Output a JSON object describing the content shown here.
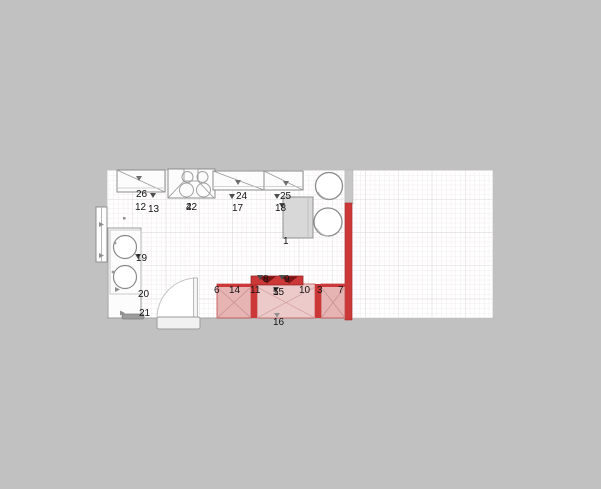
{
  "plan": {
    "type": "kitchen-floor-plan",
    "labels": {
      "n1": "1",
      "n3": "3",
      "n4": "4",
      "n5": "5",
      "n6": "6",
      "n7": "7",
      "n8": "8",
      "n9": "9",
      "n10": "10",
      "n11": "11",
      "n12": "12",
      "n13": "13",
      "n14": "14",
      "n15": "15",
      "n16": "16",
      "n17": "17",
      "n18": "18",
      "n19": "19",
      "n20": "20",
      "n21": "21",
      "n22": "22",
      "n24": "24",
      "n25": "25",
      "n26": "26"
    }
  },
  "colors": {
    "background": "#c1c1c1",
    "paper": "#ffffff",
    "grid_minor": "#f0ecec",
    "grid_major": "#ded9d9",
    "outline": "#8c8c8c",
    "wall": "#c6c6c6",
    "cabinet_fill": "#fcfcfc",
    "cabinet_gray": "#d8d8d8",
    "highlight_red": "#cc3838",
    "highlight_dark": "#7c1414",
    "highlight_pink": "#e7b4b4",
    "highlight_pink_light": "#edcaca"
  }
}
